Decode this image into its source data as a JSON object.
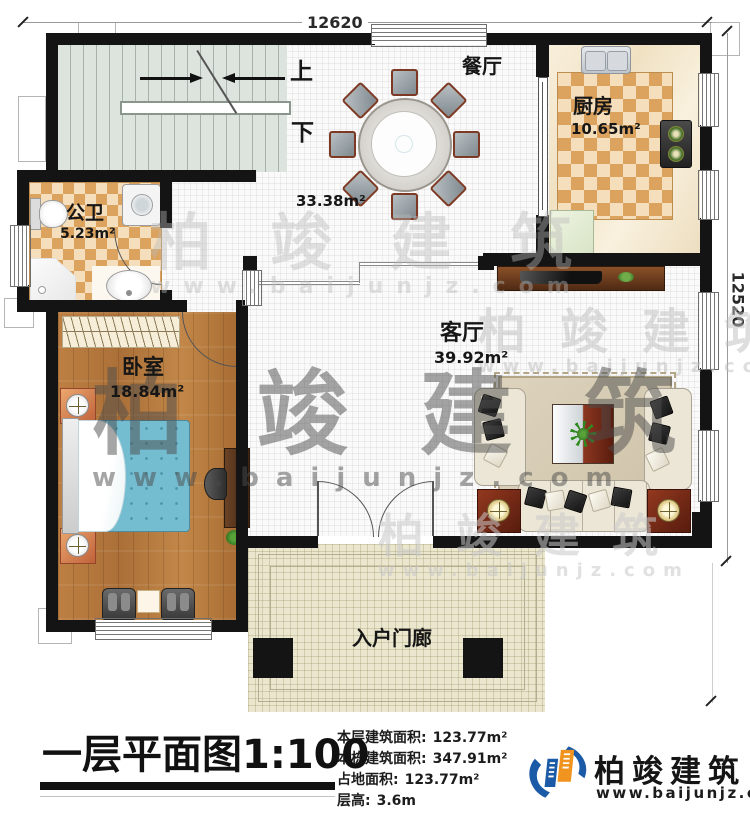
{
  "dimensions": {
    "top": "12620",
    "right": "12520"
  },
  "stairs": {
    "up": "上",
    "down": "下"
  },
  "rooms": {
    "dining": {
      "name": "餐厅",
      "area": "33.38m²"
    },
    "kitchen": {
      "name": "厨房",
      "area": "10.65m²"
    },
    "bathroom": {
      "name": "公卫",
      "area": "5.23m²"
    },
    "bedroom": {
      "name": "卧室",
      "area": "18.84m²"
    },
    "living": {
      "name": "客厅",
      "area": "39.92m²"
    },
    "porch": {
      "name": "入户门廊"
    }
  },
  "title": {
    "main": "一层平面图",
    "scale": "1:100"
  },
  "stats": [
    {
      "label": "本层建筑面积:",
      "value": "123.77m²"
    },
    {
      "label": "本栋建筑面积:",
      "value": "347.91m²"
    },
    {
      "label": "占地面积:",
      "value": "123.77m²"
    },
    {
      "label": "层高:",
      "value": "3.6m"
    }
  ],
  "brand": {
    "name": "柏竣建筑",
    "site": "www.baijunjz.com"
  },
  "watermark": {
    "text": "柏竣建筑",
    "site": "www.baijunjz.com"
  },
  "colors": {
    "wall": "#141414",
    "brand_blue": "#1b5aa6",
    "brand_orange": "#f0941f"
  }
}
